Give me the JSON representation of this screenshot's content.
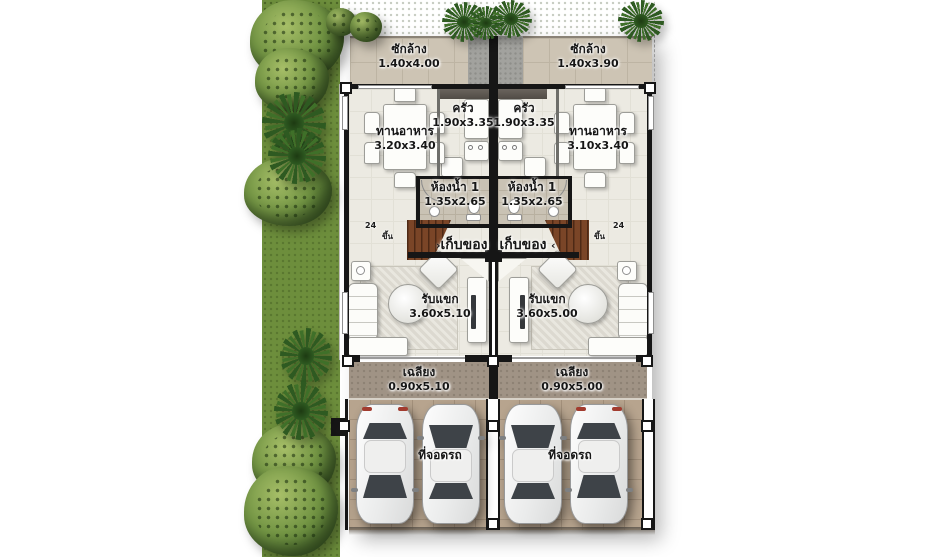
{
  "rooms": {
    "laundry_left": {
      "label": "ซักล้าง",
      "dim": "1.40x4.00"
    },
    "laundry_right": {
      "label": "ซักล้าง",
      "dim": "1.40x3.90"
    },
    "dining_left": {
      "label": "ทานอาหาร",
      "dim": "3.20x3.40"
    },
    "dining_right": {
      "label": "ทานอาหาร",
      "dim": "3.10x3.40"
    },
    "kitchen_left": {
      "label": "ครัว",
      "dim": "1.90x3.35"
    },
    "kitchen_right": {
      "label": "ครัว",
      "dim": "1.90x3.35"
    },
    "bath_left": {
      "label": "ห้องน้ำ 1",
      "dim": "1.35x2.65"
    },
    "bath_right": {
      "label": "ห้องน้ำ 1",
      "dim": "1.35x2.65"
    },
    "storage_left": {
      "label": "เก็บของ"
    },
    "storage_right": {
      "label": "เก็บของ"
    },
    "living_left": {
      "label": "รับแขก",
      "dim": "3.60x5.10"
    },
    "living_right": {
      "label": "รับแขก",
      "dim": "3.60x5.00"
    },
    "porch_left": {
      "label": "เฉลียง",
      "dim": "0.90x5.10"
    },
    "porch_right": {
      "label": "เฉลียง",
      "dim": "0.90x5.00"
    },
    "carport_left": {
      "label": "ที่จอดรถ"
    },
    "carport_right": {
      "label": "ที่จอดรถ"
    }
  },
  "annotations": {
    "up_left": "ขึ้น",
    "up_right": "ขึ้น",
    "arrow_left": "›",
    "arrow_right": "‹",
    "mark_left": "24",
    "mark_right": "24"
  },
  "colors": {
    "grass": "#6d8e3c",
    "grass_dark": "#4d6a2b",
    "tree": "#739544",
    "palm": "#2e5a21",
    "laundry_floor": "#cdc4b4",
    "concrete": "#a2a29e",
    "interior_floor": "#eceae2",
    "bath_floor": "#c9c2b4",
    "stair": "#7a4527",
    "porch_floor": "#a09385",
    "parking_floor": "#b7a48e",
    "wall": "#161616",
    "car": "#f2f2f2",
    "text": "#161616"
  }
}
